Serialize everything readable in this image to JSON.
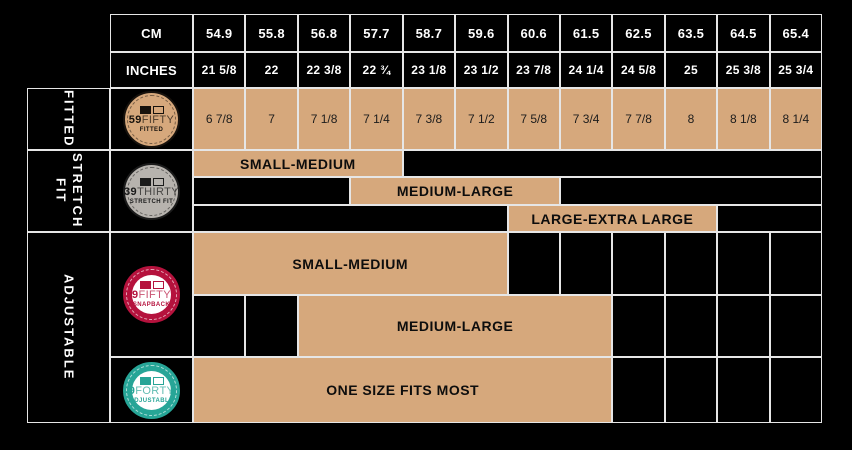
{
  "header": {
    "cm_label": "CM",
    "inches_label": "INCHES",
    "cm_values": [
      "54.9",
      "55.8",
      "56.8",
      "57.7",
      "58.7",
      "59.6",
      "60.6",
      "61.5",
      "62.5",
      "63.5",
      "64.5",
      "65.4"
    ],
    "inches_values": [
      "21 5/8",
      "22",
      "22 3/8",
      "22 ¾",
      "23 1/8",
      "23 1/2",
      "23 7/8",
      "24 1/4",
      "24 5/8",
      "25",
      "25 3/8",
      "25 3/4"
    ]
  },
  "fitted": {
    "label": "FITTED",
    "logo": {
      "num": "59",
      "word": "FIFTY",
      "sub": "FITTED"
    },
    "sizes": [
      "6 7/8",
      "7",
      "7 1/8",
      "7 1/4",
      "7 3/8",
      "7 1/2",
      "7 5/8",
      "7 3/4",
      "7 7/8",
      "8",
      "8 1/8",
      "8 1/4"
    ]
  },
  "stretch": {
    "label": "STRETCH FIT",
    "logo": {
      "num": "39",
      "word": "THIRTY",
      "sub": "STRETCH FIT"
    },
    "bands": {
      "small_medium": "SMALL-MEDIUM",
      "medium_large": "MEDIUM-LARGE",
      "large_xlarge": "LARGE-EXTRA LARGE"
    }
  },
  "adjustable": {
    "label": "ADJUSTABLE",
    "logo_9fifty": {
      "num": "9",
      "word": "FIFTY",
      "sub": "SNAPBACK"
    },
    "logo_9forty": {
      "num": "9",
      "word": "FORTY",
      "sub": "ADJUSTABLE"
    },
    "bands": {
      "small_medium": "SMALL-MEDIUM",
      "medium_large": "MEDIUM-LARGE",
      "one_size": "ONE SIZE FITS MOST"
    }
  },
  "colors": {
    "background": "#000000",
    "cell_fill": "#d6a87c",
    "grid_line": "#e6e6e6",
    "badge_59fifty": "#d6a87c",
    "badge_39thirty": "#b7b3ae",
    "badge_9fifty": "#b5123d",
    "badge_9forty": "#27a597"
  },
  "chart_data": {
    "type": "table",
    "columns_cm": [
      54.9,
      55.8,
      56.8,
      57.7,
      58.7,
      59.6,
      60.6,
      61.5,
      62.5,
      63.5,
      64.5,
      65.4
    ],
    "columns_inches": [
      "21 5/8",
      "22",
      "22 3/8",
      "22 3/4",
      "23 1/8",
      "23 1/2",
      "23 7/8",
      "24 1/4",
      "24 5/8",
      "25",
      "25 3/8",
      "25 3/4"
    ],
    "rows": [
      {
        "category": "FITTED",
        "product": "59FIFTY FITTED",
        "sizes": [
          "6 7/8",
          "7",
          "7 1/8",
          "7 1/4",
          "7 3/8",
          "7 1/2",
          "7 5/8",
          "7 3/4",
          "7 7/8",
          "8",
          "8 1/8",
          "8 1/4"
        ]
      },
      {
        "category": "STRETCH FIT",
        "product": "39THIRTY STRETCH FIT",
        "ranges": [
          {
            "label": "SMALL-MEDIUM",
            "cm_from": 54.9,
            "cm_to": 57.7
          },
          {
            "label": "MEDIUM-LARGE",
            "cm_from": 57.7,
            "cm_to": 60.6
          },
          {
            "label": "LARGE-EXTRA LARGE",
            "cm_from": 60.6,
            "cm_to": 63.5
          }
        ]
      },
      {
        "category": "ADJUSTABLE",
        "product": "9FIFTY SNAPBACK",
        "ranges": [
          {
            "label": "SMALL-MEDIUM",
            "cm_from": 54.9,
            "cm_to": 59.6
          },
          {
            "label": "MEDIUM-LARGE",
            "cm_from": 56.8,
            "cm_to": 61.5
          }
        ]
      },
      {
        "category": "ADJUSTABLE",
        "product": "9FORTY ADJUSTABLE",
        "ranges": [
          {
            "label": "ONE SIZE FITS MOST",
            "cm_from": 54.9,
            "cm_to": 61.5
          }
        ]
      }
    ],
    "legend_position": "none",
    "grid": true
  }
}
